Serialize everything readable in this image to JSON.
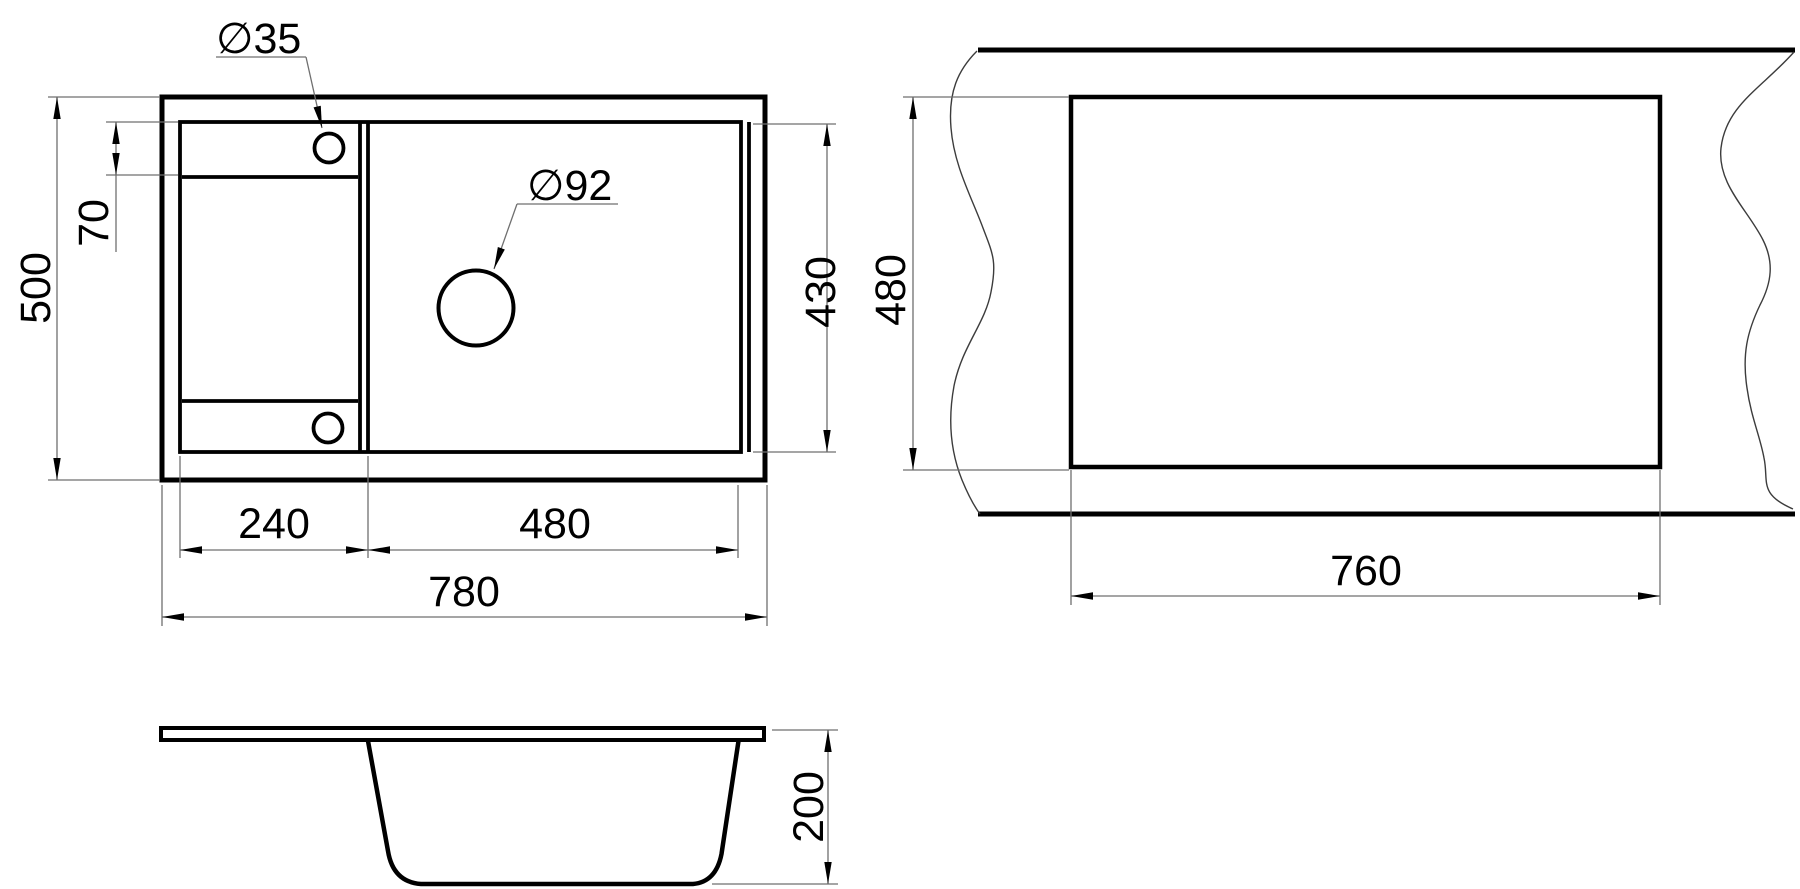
{
  "drawing": {
    "type": "technical-dimension-drawing",
    "subject": "kitchen sink with drainboard: plan view, countertop cutout view, side elevation",
    "units": "mm",
    "colors": {
      "background": "#ffffff",
      "main_line": "#000000",
      "thin_line": "#6f6f6f",
      "text": "#000000"
    }
  },
  "plan_view": {
    "overall_width": "780",
    "overall_depth": "500",
    "drainboard_width": "240",
    "bowl_width": "480",
    "bowl_inner_depth": "430",
    "tap_strip_height": "70",
    "tap_hole_diameter": "∅35",
    "drain_hole_diameter": "∅92"
  },
  "cutout_view": {
    "cutout_width": "760",
    "cutout_height": "480"
  },
  "section_view": {
    "bowl_depth": "200"
  }
}
